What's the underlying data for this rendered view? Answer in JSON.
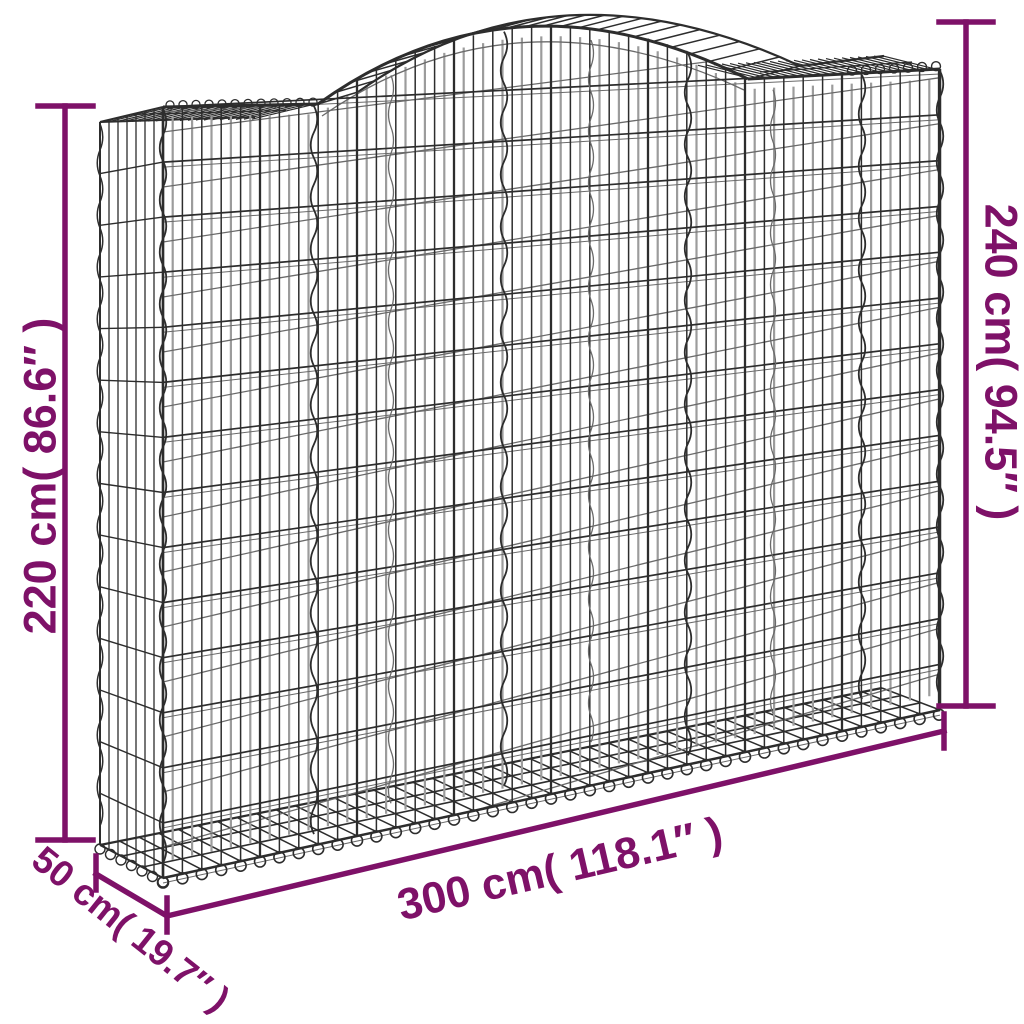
{
  "colors": {
    "accent": "#7E1168",
    "wire_dark": "#2d2d2d",
    "wire_mid": "#6a6a6a",
    "wire_light": "#9c9c9c",
    "background": "#ffffff"
  },
  "dimensions": {
    "height_left": {
      "label": "220 cm( 86.6″ )",
      "value_cm": 220,
      "value_in": "86.6″"
    },
    "height_right": {
      "label": "240 cm( 94.5″ )",
      "value_cm": 240,
      "value_in": "94.5″"
    },
    "width": {
      "label": "300 cm( 118.1″ )",
      "value_cm": 300,
      "value_in": "118.1″"
    },
    "depth": {
      "label": "50 cm( 19.7″ )",
      "value_cm": 50,
      "value_in": "19.7″"
    }
  }
}
